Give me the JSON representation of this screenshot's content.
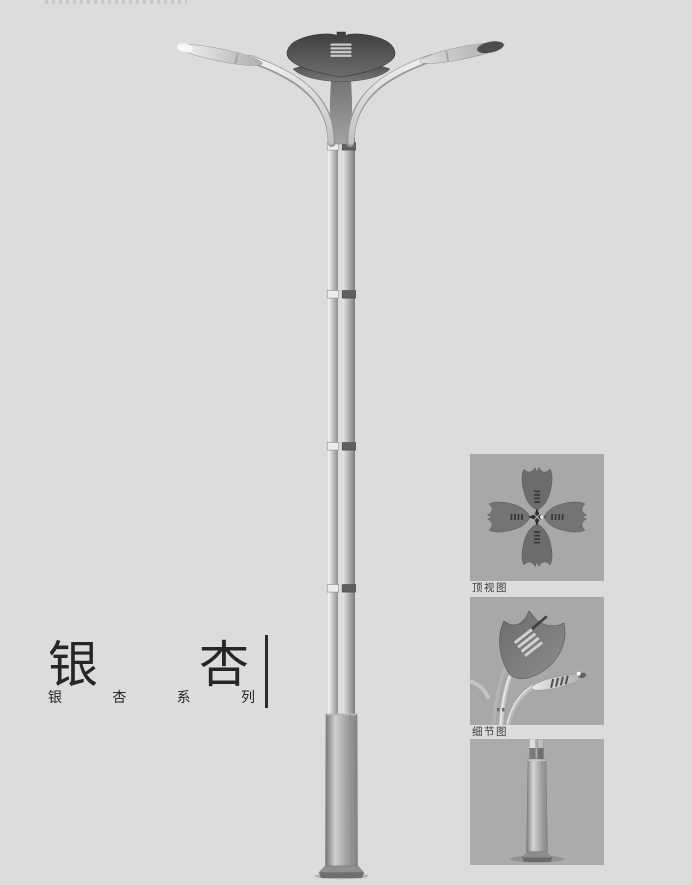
{
  "page": {
    "background_color": "#dcdcdd"
  },
  "title": {
    "text": "银杏",
    "chars": [
      "银",
      "杏"
    ],
    "series_text": "银杏系列",
    "series_chars": [
      "银",
      "杏",
      "系",
      "列"
    ],
    "color": "#262626"
  },
  "panels": [
    {
      "id": "top-view",
      "label": "顶视图"
    },
    {
      "id": "detail-view",
      "label": "细节图"
    },
    {
      "id": "base-view",
      "label": ""
    }
  ],
  "figure": {
    "subject": "double-arm ginkgo-leaf street lamp product render",
    "parts": [
      "ginkgo-crown",
      "left-arm-lamp",
      "right-arm-lamp",
      "twin-tube-pole",
      "pole-joint-collars",
      "square-base-sleeve",
      "base-plate"
    ]
  },
  "colors": {
    "panel_background": "#a8a8a8",
    "panel3_background": "#ababab",
    "caption_text": "#3c3c3c",
    "title_text": "#262626",
    "crown_dark": "#4a4a4a",
    "metal_light": "#e9e9e9",
    "metal_mid": "#b5b5b5",
    "metal_dark": "#7c7c7c"
  }
}
